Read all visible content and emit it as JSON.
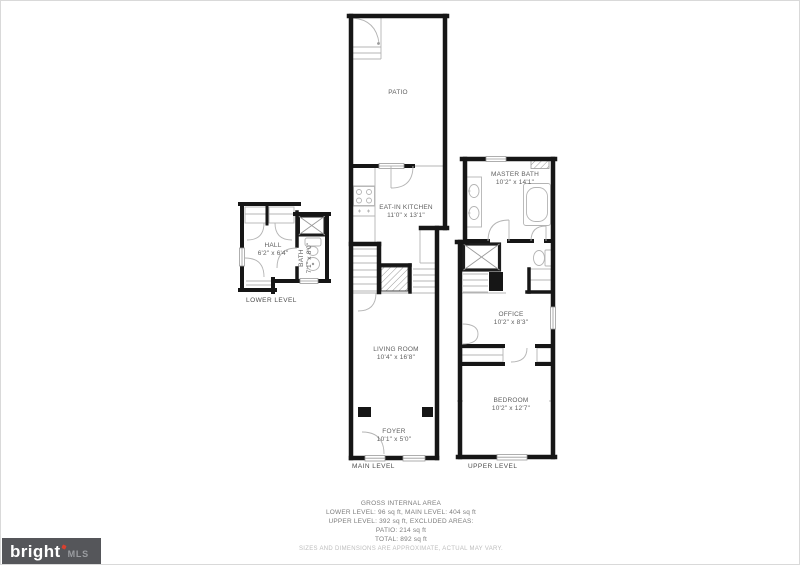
{
  "logo": {
    "brand": "bright",
    "suffix": "MLS"
  },
  "levels": {
    "lower": {
      "label": "LOWER LEVEL",
      "rooms": {
        "hall": {
          "name": "HALL",
          "dims": "6'2\" x 6'4\""
        },
        "bath": {
          "name": "BATH",
          "dims": "7'1\" x 8'0\""
        }
      }
    },
    "main": {
      "label": "MAIN LEVEL",
      "rooms": {
        "patio": {
          "name": "PATIO"
        },
        "kitchen": {
          "name": "EAT-IN KITCHEN",
          "dims": "11'0\" x 13'1\""
        },
        "living": {
          "name": "LIVING ROOM",
          "dims": "10'4\" x 16'8\""
        },
        "foyer": {
          "name": "FOYER",
          "dims": "10'1\" x 5'0\""
        }
      }
    },
    "upper": {
      "label": "UPPER LEVEL",
      "rooms": {
        "master_bath": {
          "name": "MASTER BATH",
          "dims": "10'2\" x 14'1\""
        },
        "office": {
          "name": "OFFICE",
          "dims": "10'2\" x 8'3\""
        },
        "bedroom": {
          "name": "BEDROOM",
          "dims": "10'2\" x 12'7\""
        }
      }
    }
  },
  "summary": {
    "title": "GROSS INTERNAL AREA",
    "line1": "LOWER LEVEL: 96 sq ft, MAIN LEVEL: 404 sq ft",
    "line2": "UPPER LEVEL: 392 sq ft, EXCLUDED AREAS:",
    "line3": "PATIO: 214 sq ft",
    "line4": "TOTAL: 892 sq ft",
    "disclaimer": "SIZES AND DIMENSIONS ARE APPROXIMATE, ACTUAL MAY VARY."
  },
  "colors": {
    "wall": "#161616",
    "thin_line": "#b4b4b4",
    "label_text": "#5f5f5f",
    "logo_bg": "#55565a",
    "logo_accent": "#d8402f",
    "logo_mls": "#9b9da1",
    "border": "#d9d9d9"
  }
}
